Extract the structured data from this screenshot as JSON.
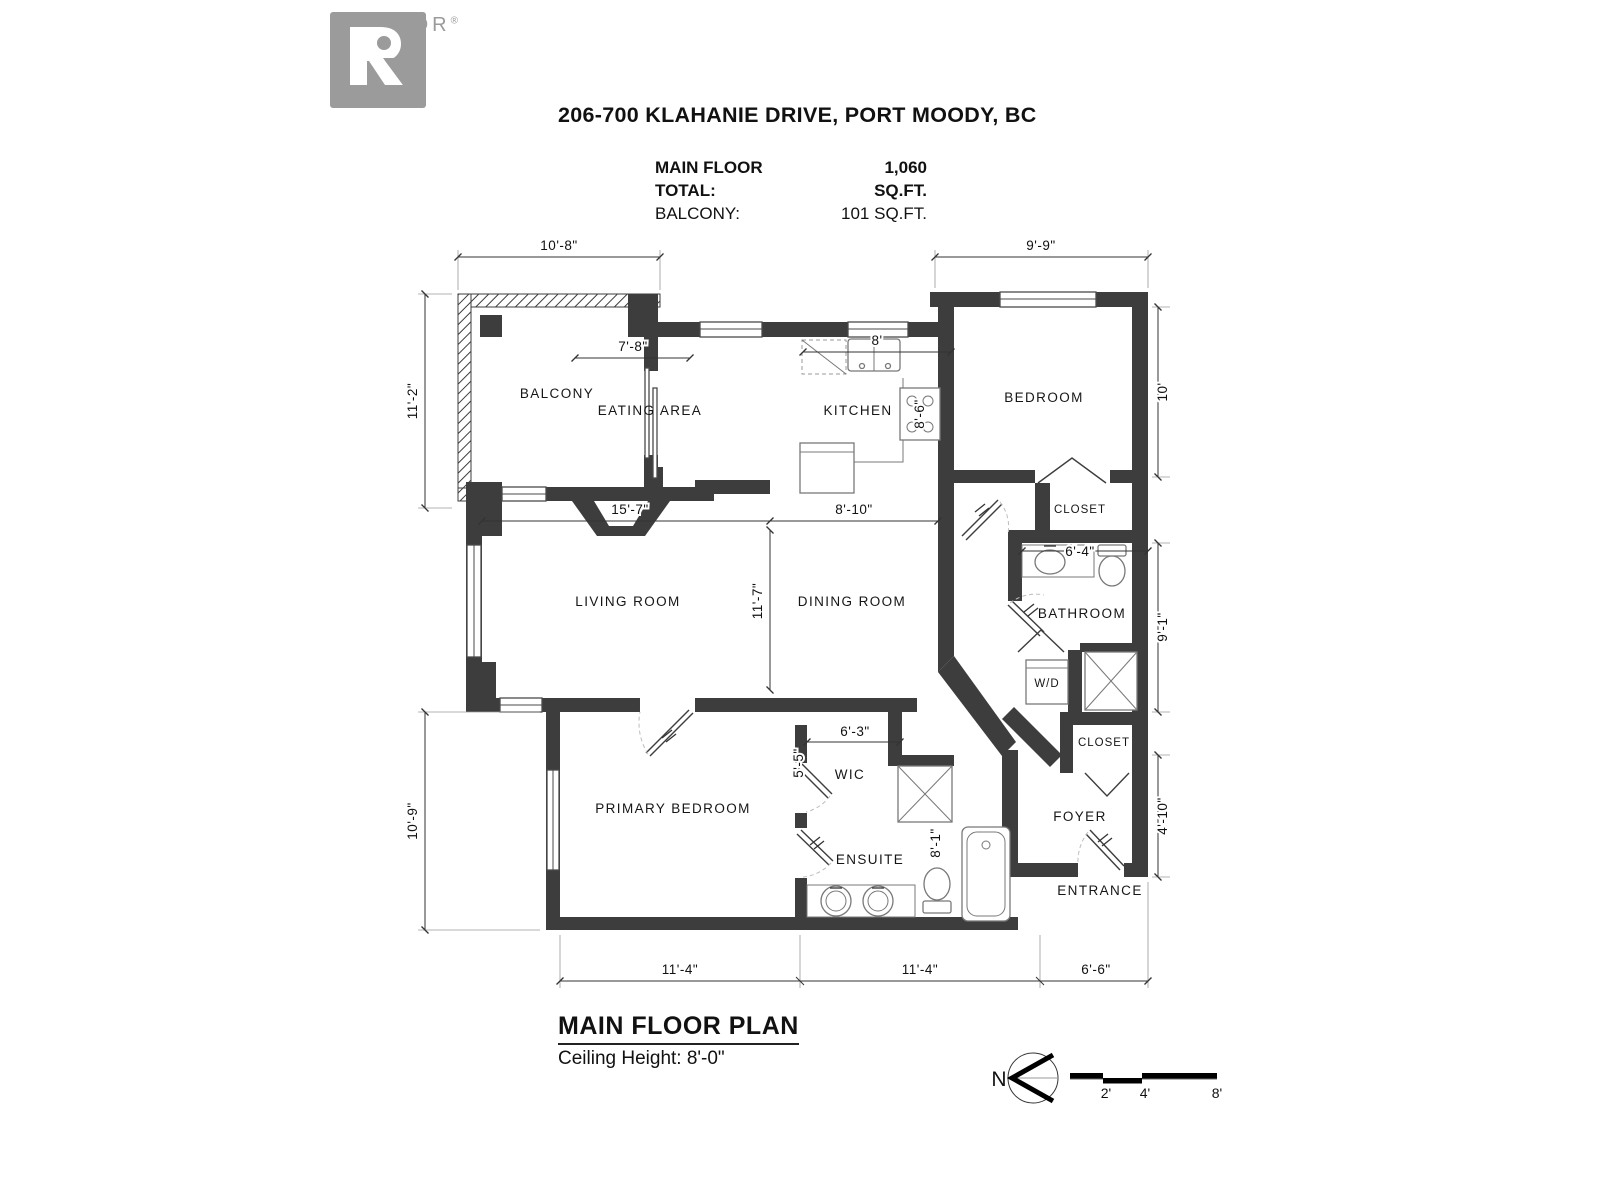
{
  "header": {
    "logo_brand": "REALTOR",
    "logo_registered": "®",
    "title": "206-700 KLAHANIE DRIVE, PORT MOODY, BC",
    "stats": [
      {
        "label": "MAIN FLOOR TOTAL:",
        "value": "1,060 SQ.FT."
      },
      {
        "label": "BALCONY:",
        "value": "101 SQ.FT."
      }
    ]
  },
  "rooms": {
    "balcony": "BALCONY",
    "eating_area": "EATING AREA",
    "kitchen": "KITCHEN",
    "bedroom": "BEDROOM",
    "bedroom_closet": "CLOSET",
    "bathroom": "BATHROOM",
    "wd": "W/D",
    "foyer_closet": "CLOSET",
    "foyer": "FOYER",
    "entrance": "ENTRANCE",
    "living_room": "LIVING ROOM",
    "dining_room": "DINING ROOM",
    "primary_bedroom": "PRIMARY BEDROOM",
    "wic": "WIC",
    "ensuite": "ENSUITE"
  },
  "dimensions": {
    "balcony_width": "10'-8\"",
    "balcony_height": "11'-2\"",
    "bedroom_width": "9'-9\"",
    "bedroom_height": "10'",
    "eating_width": "7'-8\"",
    "kitchen_width": "8'",
    "kitchen_height": "8'-6\"",
    "living_width": "15'-7\"",
    "dining_width": "8'-10\"",
    "living_height": "11'-7\"",
    "bathroom_width": "6'-4\"",
    "bathroom_height": "9'-1\"",
    "foyer_height": "4'-10\"",
    "primary_height": "10'-9\"",
    "wic_width": "6'-3\"",
    "wic_height": "5'-5\"",
    "ensuite_height": "8'-1\"",
    "bottom_left": "11'-4\"",
    "bottom_mid": "11'-4\"",
    "bottom_right": "6'-6\""
  },
  "footer": {
    "plan_title": "MAIN FLOOR PLAN",
    "ceiling": "Ceiling Height: 8'-0\""
  },
  "compass": {
    "north": "N"
  },
  "scale_bar": {
    "t2": "2'",
    "t4": "4'",
    "t8": "8'"
  }
}
